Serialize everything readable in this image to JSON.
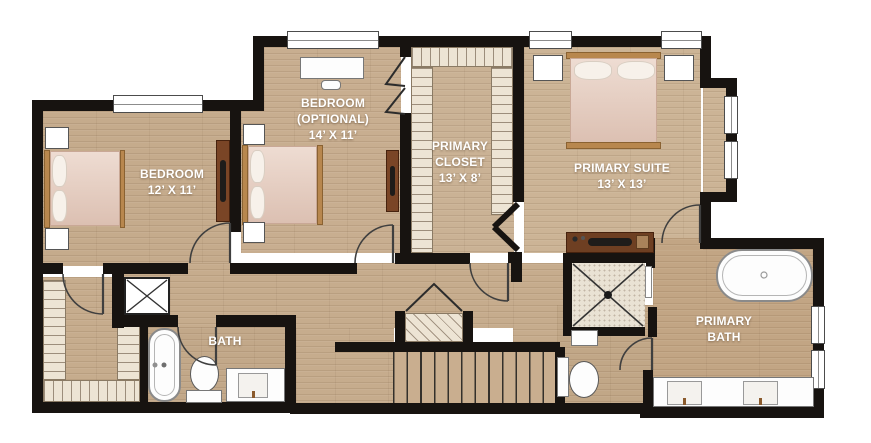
{
  "rooms": {
    "bedroom_left": {
      "line1": "BEDROOM",
      "line2": "12’ X 11’"
    },
    "bedroom_optional": {
      "line1": "BEDROOM",
      "line2": "(OPTIONAL)",
      "line3": "14’ X 11’"
    },
    "primary_closet": {
      "line1": "PRIMARY",
      "line2": "CLOSET",
      "line3": "13’ X 8’"
    },
    "primary_suite": {
      "line1": "PRIMARY SUITE",
      "line2": "13’ X 13’"
    },
    "bath": {
      "line1": "BATH"
    },
    "primary_bath": {
      "line1": "PRIMARY",
      "line2": "BATH"
    }
  },
  "colors": {
    "wall": "#171310",
    "floor": "#c6ac8d",
    "floor_suite": "#ccb496",
    "shelf_hatch": "#ede4d4",
    "hatch_line": "#6b5b48",
    "label_text": "#ffffff",
    "bed_wood": "#b8874e",
    "dresser_wood": "#7a4526",
    "shower_tile": "#e9e2d4",
    "fixture_white": "#fdfdfd"
  }
}
